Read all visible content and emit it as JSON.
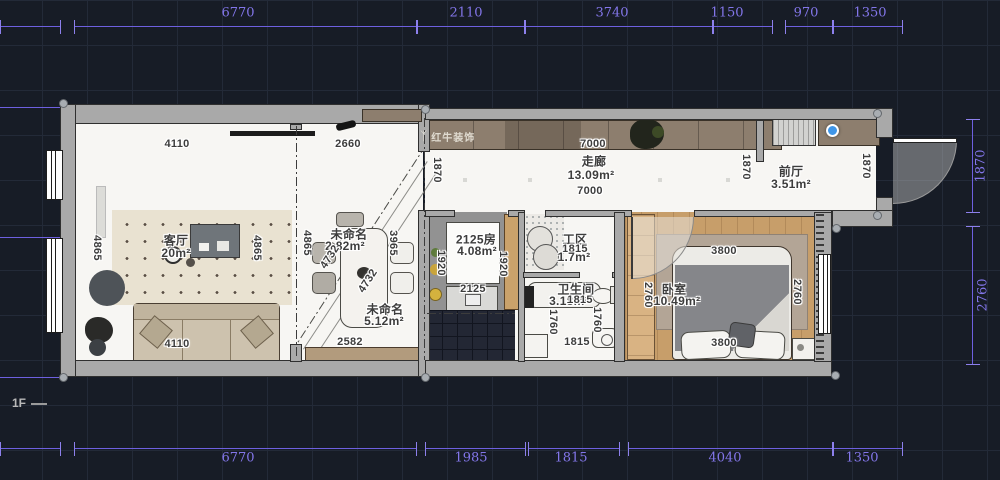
{
  "floor_label": "1F",
  "brand": {
    "name": "红牛装饰",
    "icon": "deer-logo"
  },
  "colors": {
    "background": "#171c26",
    "grid_line": "#232a38",
    "dimension_purple": "#7b6ce8",
    "wall_gray": "#a9a9a9",
    "floor_white": "#f7f6f3",
    "wood_floor": "#c79e6a",
    "cabinet_brown": "#8d7e6e",
    "dark_tile": "#232734",
    "selection_blue": "#3f96e8",
    "dim_text": "#3d3d3d"
  },
  "outer_dimensions": {
    "top": [
      "6770",
      "2110",
      "3740",
      "1150",
      "970",
      "1350"
    ],
    "bottom": [
      "6770",
      "1985",
      "1815",
      "4040",
      "1350"
    ],
    "right": [
      "1870",
      "2760"
    ]
  },
  "rooms": {
    "living": {
      "name": "客厅",
      "area": "20m²"
    },
    "dining_upper": {
      "name": "未命名",
      "area": "2.82m²"
    },
    "dining_lower": {
      "name": "未命名",
      "area": "5.12m²"
    },
    "kitchen": {
      "name": "2125房",
      "area": "4.08m²"
    },
    "corridor": {
      "name": "走廊",
      "area": "13.09m²"
    },
    "front_hall": {
      "name": "前厅",
      "area": "3.51m²"
    },
    "work_zone": {
      "name": "工区",
      "area": "1.7m²"
    },
    "bathroom": {
      "name": "卫生间",
      "area": "3.18m²"
    },
    "bedroom": {
      "name": "卧室",
      "area": "10.49m²"
    }
  },
  "plan_dimensions": {
    "living_top": "4110",
    "living_bottom": "4110",
    "living_left": "4865",
    "living_right": "4865",
    "dining_top": "2660",
    "dining_left": "4865",
    "dining_right": "3965",
    "dining_diag_a": "4732",
    "dining_diag_b": "4732",
    "dining_bottom": "2582",
    "kitchen_left": "1920",
    "kitchen_right": "1920",
    "kitchen_bottom": "2125",
    "corridor_top": "7000",
    "corridor_bottom": "7000",
    "corridor_left": "1870",
    "corridor_mid": "1870",
    "corridor_right": "1870",
    "work_zone_width": "1815",
    "bathroom_left": "1760",
    "bathroom_right": "1760",
    "bathroom_mid": "1815",
    "bathroom_bottom": "1815",
    "bedroom_top": "3800",
    "bedroom_bottom": "3800",
    "bedroom_left": "2760",
    "bedroom_right": "2760"
  }
}
